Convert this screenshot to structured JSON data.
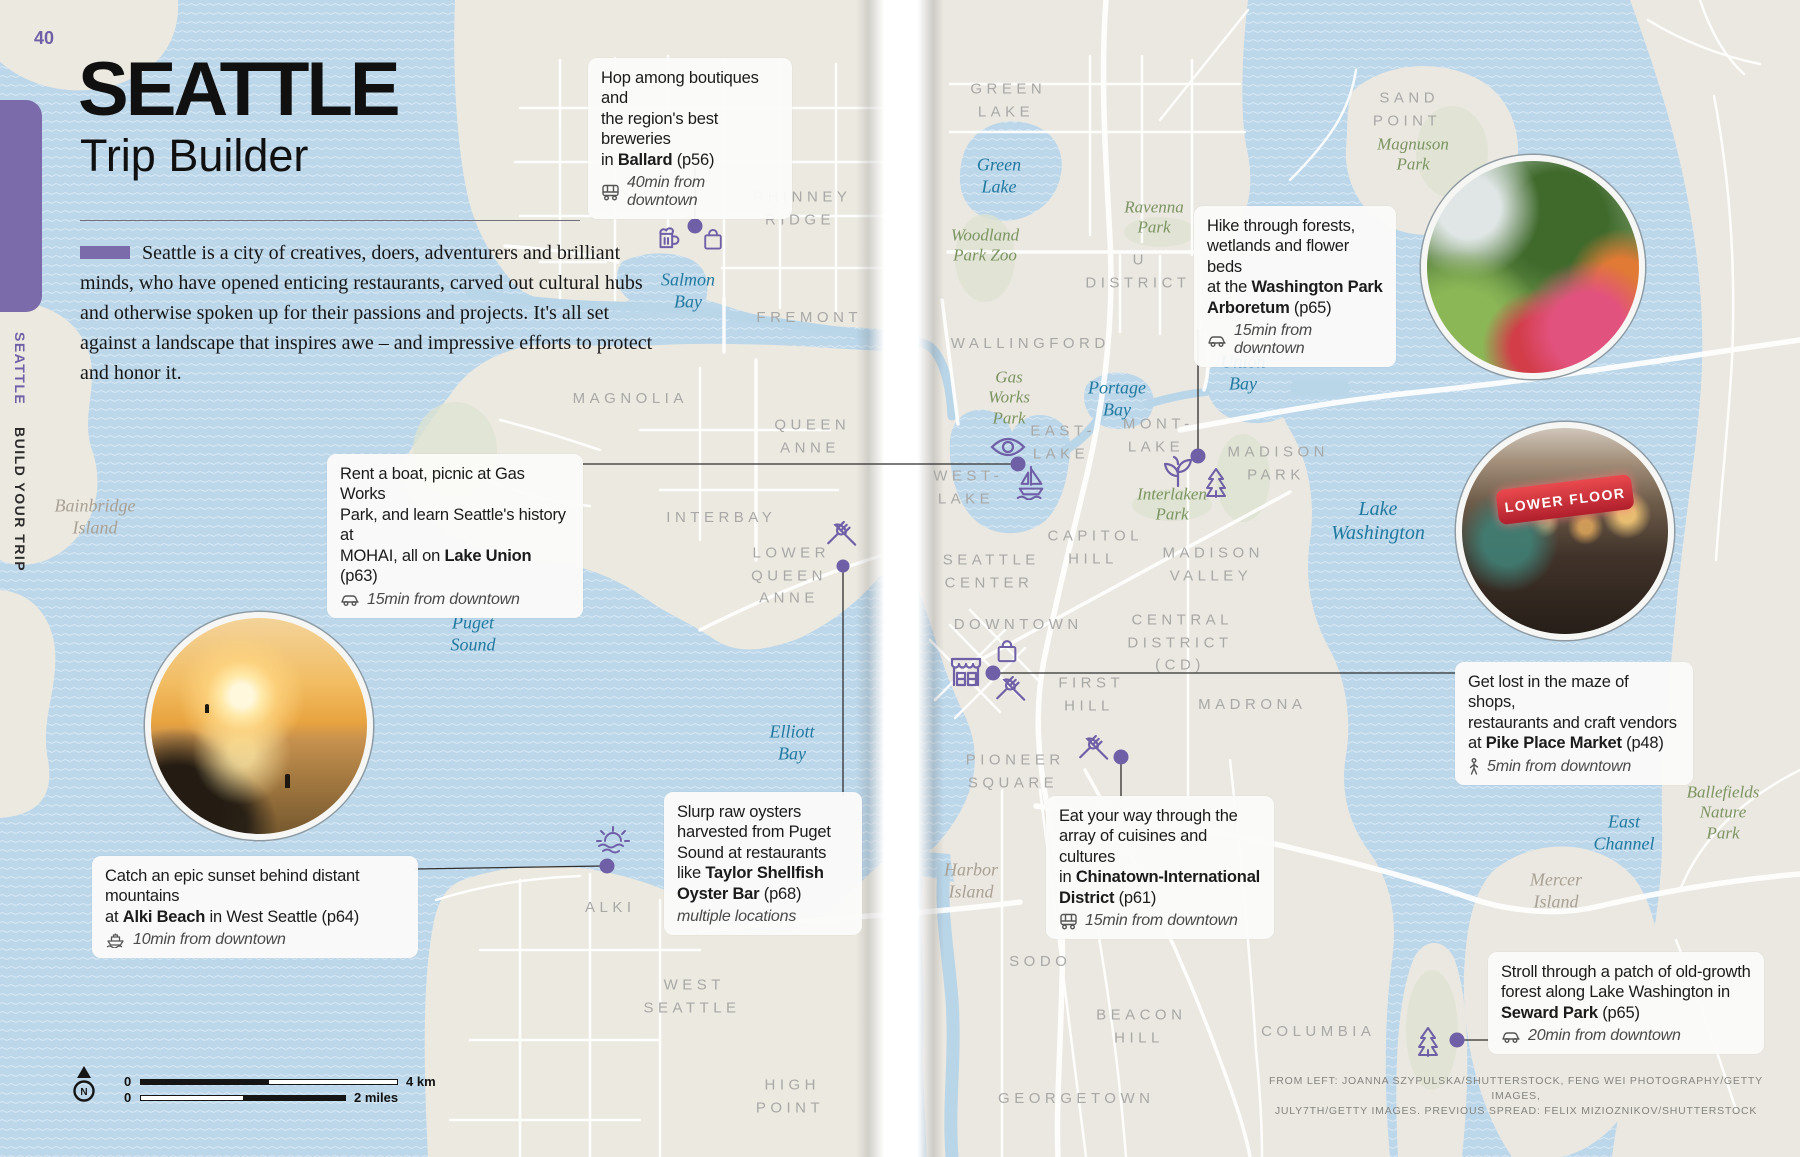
{
  "page_number": "40",
  "sidebar": {
    "primary": "SEATTLE",
    "secondary": "BUILD YOUR TRIP"
  },
  "header": {
    "title": "SEATTLE",
    "subtitle": "Trip Builder",
    "intro": "Seattle is a city of creatives, doers, adventurers and brilliant minds, who have opened enticing restaurants, carved out cultural hubs and otherwise spoken up for their passions and projects. It's all set against a landscape that inspires awe – and impressive efforts to protect and honor it."
  },
  "callouts": [
    {
      "id": "ballard",
      "pre": "Hop among boutiques and\nthe region's best breweries\nin ",
      "bold": "Ballard",
      "post": " (p56)",
      "icon": "bus-icon",
      "meta": "40min from downtown"
    },
    {
      "id": "arboretum",
      "pre": "Hike through forests,\nwetlands and flower beds\nat the ",
      "bold": "Washington Park\nArboretum",
      "post": " (p65)",
      "icon": "car-icon",
      "meta": "15min from downtown"
    },
    {
      "id": "lake-union",
      "pre": "Rent a boat, picnic at Gas Works\nPark, and learn Seattle's history at\nMOHAI, all on ",
      "bold": "Lake Union",
      "post": " (p63)",
      "icon": "car-icon",
      "meta": "15min from downtown"
    },
    {
      "id": "alki-beach",
      "pre": "Catch an epic sunset behind distant mountains\nat ",
      "bold": "Alki Beach",
      "post": " in West Seattle (p64)",
      "icon": "ferry-icon",
      "meta": "10min from downtown"
    },
    {
      "id": "oysters",
      "pre": "Slurp raw oysters\nharvested from Puget\nSound at restaurants\nlike ",
      "bold": "Taylor Shellfish\nOyster Bar",
      "post": " (p68)",
      "icon": "none",
      "meta": "multiple locations"
    },
    {
      "id": "chinatown",
      "pre": "Eat your way through the\narray of cuisines and cultures\nin ",
      "bold": "Chinatown-International\nDistrict",
      "post": " (p61)",
      "icon": "bus-icon",
      "meta": "15min from downtown"
    },
    {
      "id": "pike-place",
      "pre": "Get lost in the maze of shops,\nrestaurants and craft vendors\nat ",
      "bold": "Pike Place Market",
      "post": " (p48)",
      "icon": "walk-icon",
      "meta": "5min from downtown"
    },
    {
      "id": "seward-park",
      "pre": "Stroll through a patch of old-growth\nforest along Lake Washington in\n",
      "bold": "Seward Park",
      "post": " (p65)",
      "icon": "car-icon",
      "meta": "20min from downtown"
    }
  ],
  "map": {
    "neighborhood_labels": [
      {
        "text": "PHINNEY\nRIDGE"
      },
      {
        "text": "FREMONT"
      },
      {
        "text": "MAGNOLIA"
      },
      {
        "text": "QUEEN\nANNE"
      },
      {
        "text": "INTERBAY"
      },
      {
        "text": "LOWER\nQUEEN\nANNE"
      },
      {
        "text": "WALLINGFORD"
      },
      {
        "text": "GREEN\nLAKE"
      },
      {
        "text": "U\nDISTRICT"
      },
      {
        "text": "SAND\nPOINT"
      },
      {
        "text": "EAST-\nLAKE"
      },
      {
        "text": "WEST-\nLAKE"
      },
      {
        "text": "MONT-\nLAKE"
      },
      {
        "text": "MADISON\nPARK"
      },
      {
        "text": "CAPITOL\nHILL"
      },
      {
        "text": "MADISON\nVALLEY"
      },
      {
        "text": "SEATTLE\nCENTER"
      },
      {
        "text": "DOWNTOWN"
      },
      {
        "text": "CENTRAL\nDISTRICT\n(CD)"
      },
      {
        "text": "FIRST\nHILL"
      },
      {
        "text": "MADRONA"
      },
      {
        "text": "PIONEER\nSQUARE"
      },
      {
        "text": "SODO"
      },
      {
        "text": "BEACON\nHILL"
      },
      {
        "text": "COLUMBIA"
      },
      {
        "text": "GEORGETOWN"
      },
      {
        "text": "ALKI"
      },
      {
        "text": "WEST\nSEATTLE"
      },
      {
        "text": "HIGH\nPOINT"
      }
    ],
    "water_labels": [
      {
        "text": "Salmon\nBay"
      },
      {
        "text": "Green\nLake"
      },
      {
        "text": "Union\nBay"
      },
      {
        "text": "Portage\nBay"
      },
      {
        "text": "Lake\nWashington"
      },
      {
        "text": "Puget\nSound"
      },
      {
        "text": "Elliott\nBay"
      },
      {
        "text": "East\nChannel"
      }
    ],
    "park_labels": [
      {
        "text": "Woodland\nPark Zoo"
      },
      {
        "text": "Ravenna\nPark"
      },
      {
        "text": "Magnuson\nPark"
      },
      {
        "text": "Gas\nWorks\nPark"
      },
      {
        "text": "Interlaken\nPark"
      },
      {
        "text": "Ballefields\nNature\nPark"
      }
    ],
    "area_labels": [
      {
        "text": "Bainbridge\nIsland"
      },
      {
        "text": "Harbor\nIsland"
      },
      {
        "text": "Mercer\nIsland"
      }
    ]
  },
  "photos": [
    {
      "name": "arboretum-photo"
    },
    {
      "name": "pike-place-market-photo",
      "sign_text": "LOWER FLOOR"
    },
    {
      "name": "alki-beach-sunset-photo"
    }
  ],
  "scale": {
    "north": "N",
    "km_zero": "0",
    "km_label": "4 km",
    "mi_zero": "0",
    "mi_label": "2 miles"
  },
  "credits": "FROM LEFT: JOANNA SZYPULSKA/SHUTTERSTOCK, FENG WEI PHOTOGRAPHY/GETTY IMAGES,\nJULY7TH/GETTY IMAGES. PREVIOUS SPREAD: FELIX MIZIOZNIKOV/SHUTTERSTOCK",
  "colors": {
    "accent_purple": "#6f5fa6",
    "water": "#bcd7ea",
    "land": "#ebe8e1",
    "water_label": "#2279a0",
    "park_label": "#7b9461",
    "neighborhood_label": "#a8a8a6"
  }
}
